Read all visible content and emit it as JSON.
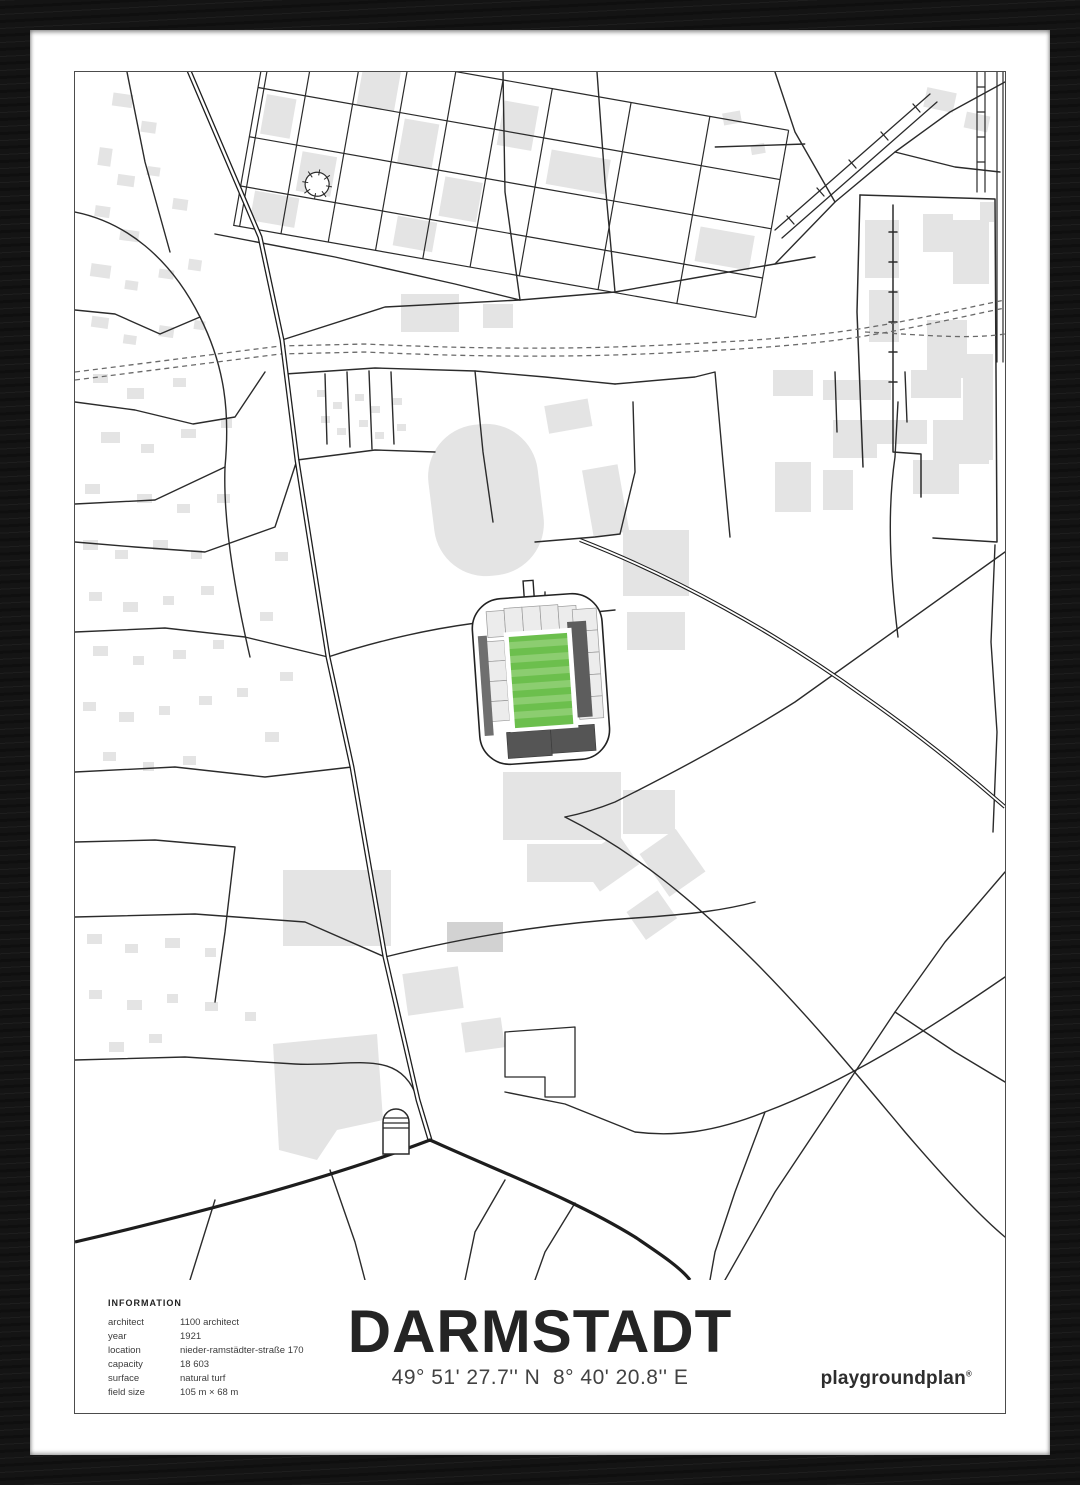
{
  "poster": {
    "title": "DARMSTADT",
    "coordinates": "49° 51' 27.7'' N  8° 40' 20.8'' E",
    "brand": "playgroundplan",
    "brand_mark": "®",
    "information": {
      "heading": "INFORMATION",
      "rows": [
        {
          "label": "architect",
          "value": "1100 architect"
        },
        {
          "label": "year",
          "value": "1921"
        },
        {
          "label": "location",
          "value": "nieder-ramstädter-straße 170"
        },
        {
          "label": "capacity",
          "value": "18 603"
        },
        {
          "label": "surface",
          "value": "natural turf"
        },
        {
          "label": "field size",
          "value": "105 m × 68 m"
        }
      ]
    },
    "map": {
      "highlight": "stadium",
      "colors": {
        "frame": "#141414",
        "mat": "#ffffff",
        "road": "#2b2b2b",
        "railway": "#6a6a6a",
        "building": "#e4e4e4",
        "stand_light": "#ececec",
        "stand_dark": "#5d5d5d",
        "pitch_green": "#6cbf4d",
        "pitch_green_light": "#8ccd70"
      }
    }
  }
}
